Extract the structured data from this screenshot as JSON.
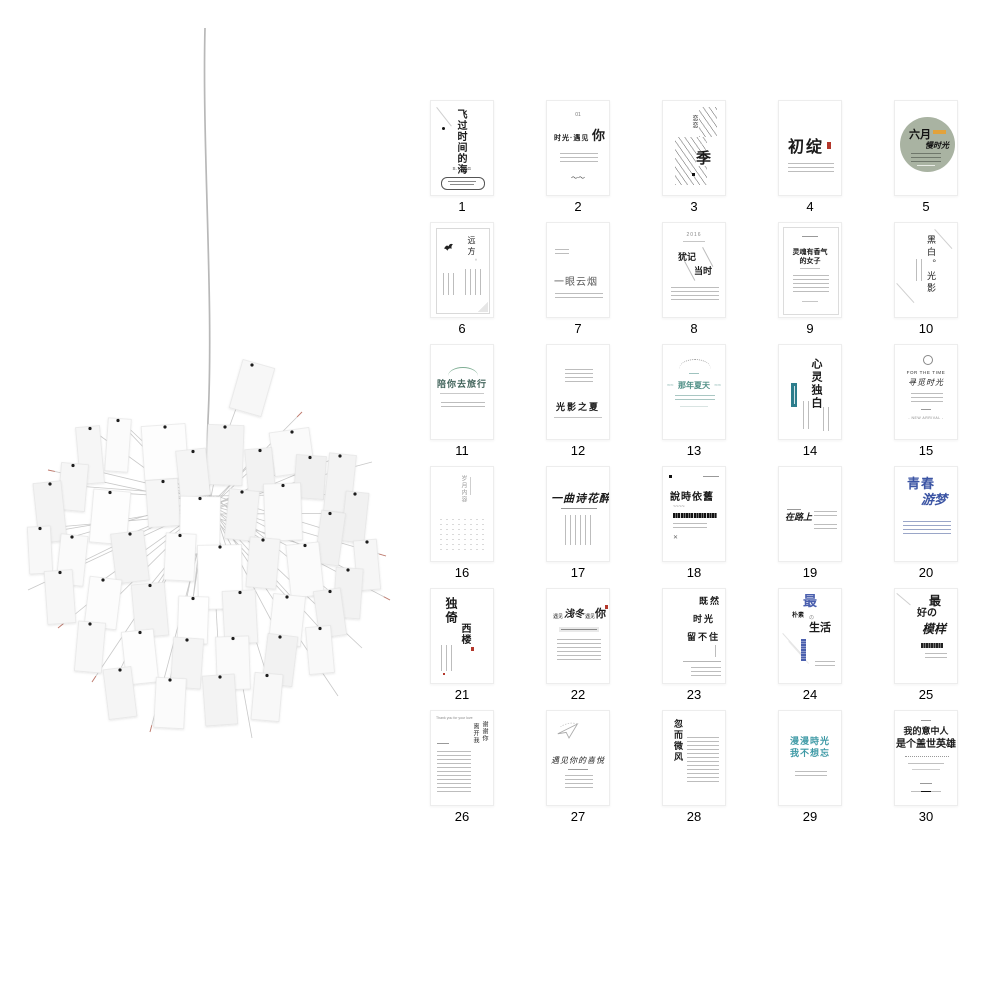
{
  "page": {
    "background": "#ffffff"
  },
  "colors": {
    "sage_circle": "#a9b3a2",
    "orange_badge": "#e2a23c",
    "teal_waves": "#4f8f86",
    "teal_banner": "#2c7d8c",
    "blue_calligraphy": "#3c55a4",
    "blue_ribbon": "#4a5fae",
    "teal_text": "#3f9aa6",
    "green_arc": "#7fae94",
    "seal_red": "#b3372b",
    "paper_white": "#ffffff",
    "wire_gray": "#c8c8c8"
  },
  "lamp": {
    "hub": {
      "x": 210,
      "y": 505
    },
    "cord": "M205,28 C202,150 214,300 208,420 C206,470 210,490 210,505",
    "cord_color": "#b8b8b8",
    "wire_color": "#c8c8c8",
    "clip_color": "#1d1d1d",
    "papers": [
      [
        252,
        388,
        33,
        50,
        16,
        "#f7f7f7"
      ],
      [
        165,
        452,
        44,
        54,
        -4,
        "#fdfdfd"
      ],
      [
        225,
        455,
        36,
        60,
        2,
        "#f4f4f4"
      ],
      [
        292,
        452,
        40,
        44,
        -8,
        "#fafafa"
      ],
      [
        340,
        483,
        27,
        58,
        6,
        "#f3f3f3"
      ],
      [
        90,
        455,
        24,
        57,
        -5,
        "#f6f6f6"
      ],
      [
        118,
        445,
        23,
        53,
        4,
        "#fbfbfb"
      ],
      [
        50,
        512,
        28,
        60,
        -6,
        "#f3f3f3"
      ],
      [
        110,
        517,
        37,
        53,
        5,
        "#fdfdfd"
      ],
      [
        163,
        503,
        32,
        47,
        -4,
        "#f6f6f6"
      ],
      [
        200,
        525,
        40,
        57,
        1,
        "#ffffff"
      ],
      [
        242,
        515,
        30,
        50,
        6,
        "#f4f4f4"
      ],
      [
        283,
        512,
        37,
        57,
        -2,
        "#fafafa"
      ],
      [
        330,
        538,
        24,
        53,
        8,
        "#f1f1f1"
      ],
      [
        367,
        565,
        23,
        50,
        -5,
        "#f6f6f6"
      ],
      [
        72,
        560,
        27,
        50,
        6,
        "#fafafa"
      ],
      [
        130,
        557,
        33,
        50,
        -7,
        "#f3f3f3"
      ],
      [
        180,
        557,
        30,
        47,
        3,
        "#fcfcfc"
      ],
      [
        220,
        577,
        44,
        64,
        -1,
        "#ffffff"
      ],
      [
        263,
        563,
        30,
        50,
        5,
        "#f5f5f5"
      ],
      [
        305,
        570,
        33,
        53,
        -6,
        "#fbfbfb"
      ],
      [
        348,
        593,
        27,
        50,
        4,
        "#f2f2f2"
      ],
      [
        60,
        597,
        28,
        53,
        -4,
        "#f7f7f7"
      ],
      [
        103,
        603,
        32,
        50,
        7,
        "#fcfcfc"
      ],
      [
        150,
        610,
        33,
        53,
        -5,
        "#f4f4f4"
      ],
      [
        193,
        620,
        30,
        47,
        2,
        "#fefefe"
      ],
      [
        240,
        617,
        33,
        53,
        -3,
        "#f6f6f6"
      ],
      [
        287,
        620,
        32,
        50,
        6,
        "#fbfbfb"
      ],
      [
        330,
        613,
        27,
        47,
        -8,
        "#f3f3f3"
      ],
      [
        90,
        647,
        27,
        50,
        5,
        "#f8f8f8"
      ],
      [
        140,
        657,
        32,
        53,
        -6,
        "#fdfdfd"
      ],
      [
        187,
        663,
        30,
        50,
        4,
        "#f4f4f4"
      ],
      [
        233,
        663,
        33,
        53,
        -2,
        "#fafafa"
      ],
      [
        280,
        660,
        30,
        50,
        7,
        "#f2f2f2"
      ],
      [
        320,
        650,
        25,
        47,
        -5,
        "#f9f9f9"
      ],
      [
        120,
        693,
        28,
        50,
        -7,
        "#f5f5f5"
      ],
      [
        170,
        703,
        30,
        50,
        3,
        "#fbfbfb"
      ],
      [
        220,
        700,
        32,
        50,
        -4,
        "#f3f3f3"
      ],
      [
        267,
        697,
        28,
        47,
        5,
        "#f8f8f8"
      ],
      [
        193,
        473,
        30,
        47,
        -6,
        "#f5f5f5"
      ],
      [
        310,
        477,
        30,
        43,
        4,
        "#f0f0f0"
      ],
      [
        40,
        550,
        23,
        47,
        -3,
        "#f8f8f8"
      ],
      [
        355,
        517,
        23,
        50,
        6,
        "#f1f1f1"
      ],
      [
        73,
        487,
        27,
        47,
        5,
        "#f6f6f6"
      ],
      [
        260,
        470,
        27,
        43,
        -5,
        "#f2f2f2"
      ]
    ],
    "spokes": [
      [
        48,
        470,
        1
      ],
      [
        32,
        535,
        0
      ],
      [
        58,
        628,
        1
      ],
      [
        118,
        418,
        0
      ],
      [
        302,
        412,
        1
      ],
      [
        372,
        462,
        0
      ],
      [
        386,
        556,
        1
      ],
      [
        362,
        648,
        0
      ],
      [
        150,
        732,
        1
      ],
      [
        252,
        738,
        0
      ],
      [
        92,
        682,
        1
      ],
      [
        338,
        696,
        0
      ],
      [
        28,
        590,
        0
      ],
      [
        390,
        600,
        1
      ]
    ]
  },
  "grid": {
    "cards": [
      {
        "num": "1",
        "t1": "飞过时间的海",
        "t2": "S.I.W.G"
      },
      {
        "num": "2",
        "t1": "01",
        "t2": "时光·遇见",
        "t3": "你",
        "t4": "〜〜"
      },
      {
        "num": "3",
        "t1": "恋恋",
        "t2": "季"
      },
      {
        "num": "4",
        "t1": "初绽"
      },
      {
        "num": "5",
        "t1": "六月",
        "t2": "慢时光"
      },
      {
        "num": "6",
        "t1": "远方",
        "t2": "。"
      },
      {
        "num": "7",
        "t1": "一眼云烟"
      },
      {
        "num": "8",
        "t1": "2016",
        "t2": "犹记",
        "t3": "当时"
      },
      {
        "num": "9",
        "t1": "灵魂有香气",
        "t2": "的女子"
      },
      {
        "num": "10",
        "t1": "黑白。光影"
      },
      {
        "num": "11",
        "t1": "陪你去旅行"
      },
      {
        "num": "12",
        "t1": "光影之夏"
      },
      {
        "num": "13",
        "t1": "那年夏天",
        "t2": "≈≈",
        "t3": "≈≈"
      },
      {
        "num": "14",
        "t1": "心灵独白"
      },
      {
        "num": "15",
        "t1": "FOR THE TIME",
        "t2": "寻觅时光",
        "t3": "- NEW ARRIVAL -"
      },
      {
        "num": "16",
        "t1": "岁月内容"
      },
      {
        "num": "17",
        "t1": "一曲诗花醉"
      },
      {
        "num": "18",
        "t1": "說時依舊",
        "t2": "✕",
        "t3": "~~~~"
      },
      {
        "num": "19",
        "t1": "在路上"
      },
      {
        "num": "20",
        "t1": "青春",
        "t2": "游梦"
      },
      {
        "num": "21",
        "t1": "独倚",
        "t2": "西楼"
      },
      {
        "num": "22",
        "t1": "遇见",
        "t2": "浅冬",
        "t3": "遇见",
        "t4": "你"
      },
      {
        "num": "23",
        "t1": "既然",
        "t2": "时光",
        "t3": "留不住"
      },
      {
        "num": "24",
        "t1": "最",
        "t2": "朴素",
        "t3": "の",
        "t4": "生活"
      },
      {
        "num": "25",
        "t1": "最",
        "t2": "好の",
        "t3": "模样"
      },
      {
        "num": "26",
        "t1": "Thank you for your love",
        "t2": "谢谢你",
        "t3": "离开我"
      },
      {
        "num": "27",
        "t1": "遇见你的喜悦"
      },
      {
        "num": "28",
        "t1": "忽而微风"
      },
      {
        "num": "29",
        "t1": "漫漫時光",
        "t2": "我不想忘"
      },
      {
        "num": "30",
        "t1": "我的意中人",
        "t2": "是个盖世英雄"
      }
    ]
  }
}
